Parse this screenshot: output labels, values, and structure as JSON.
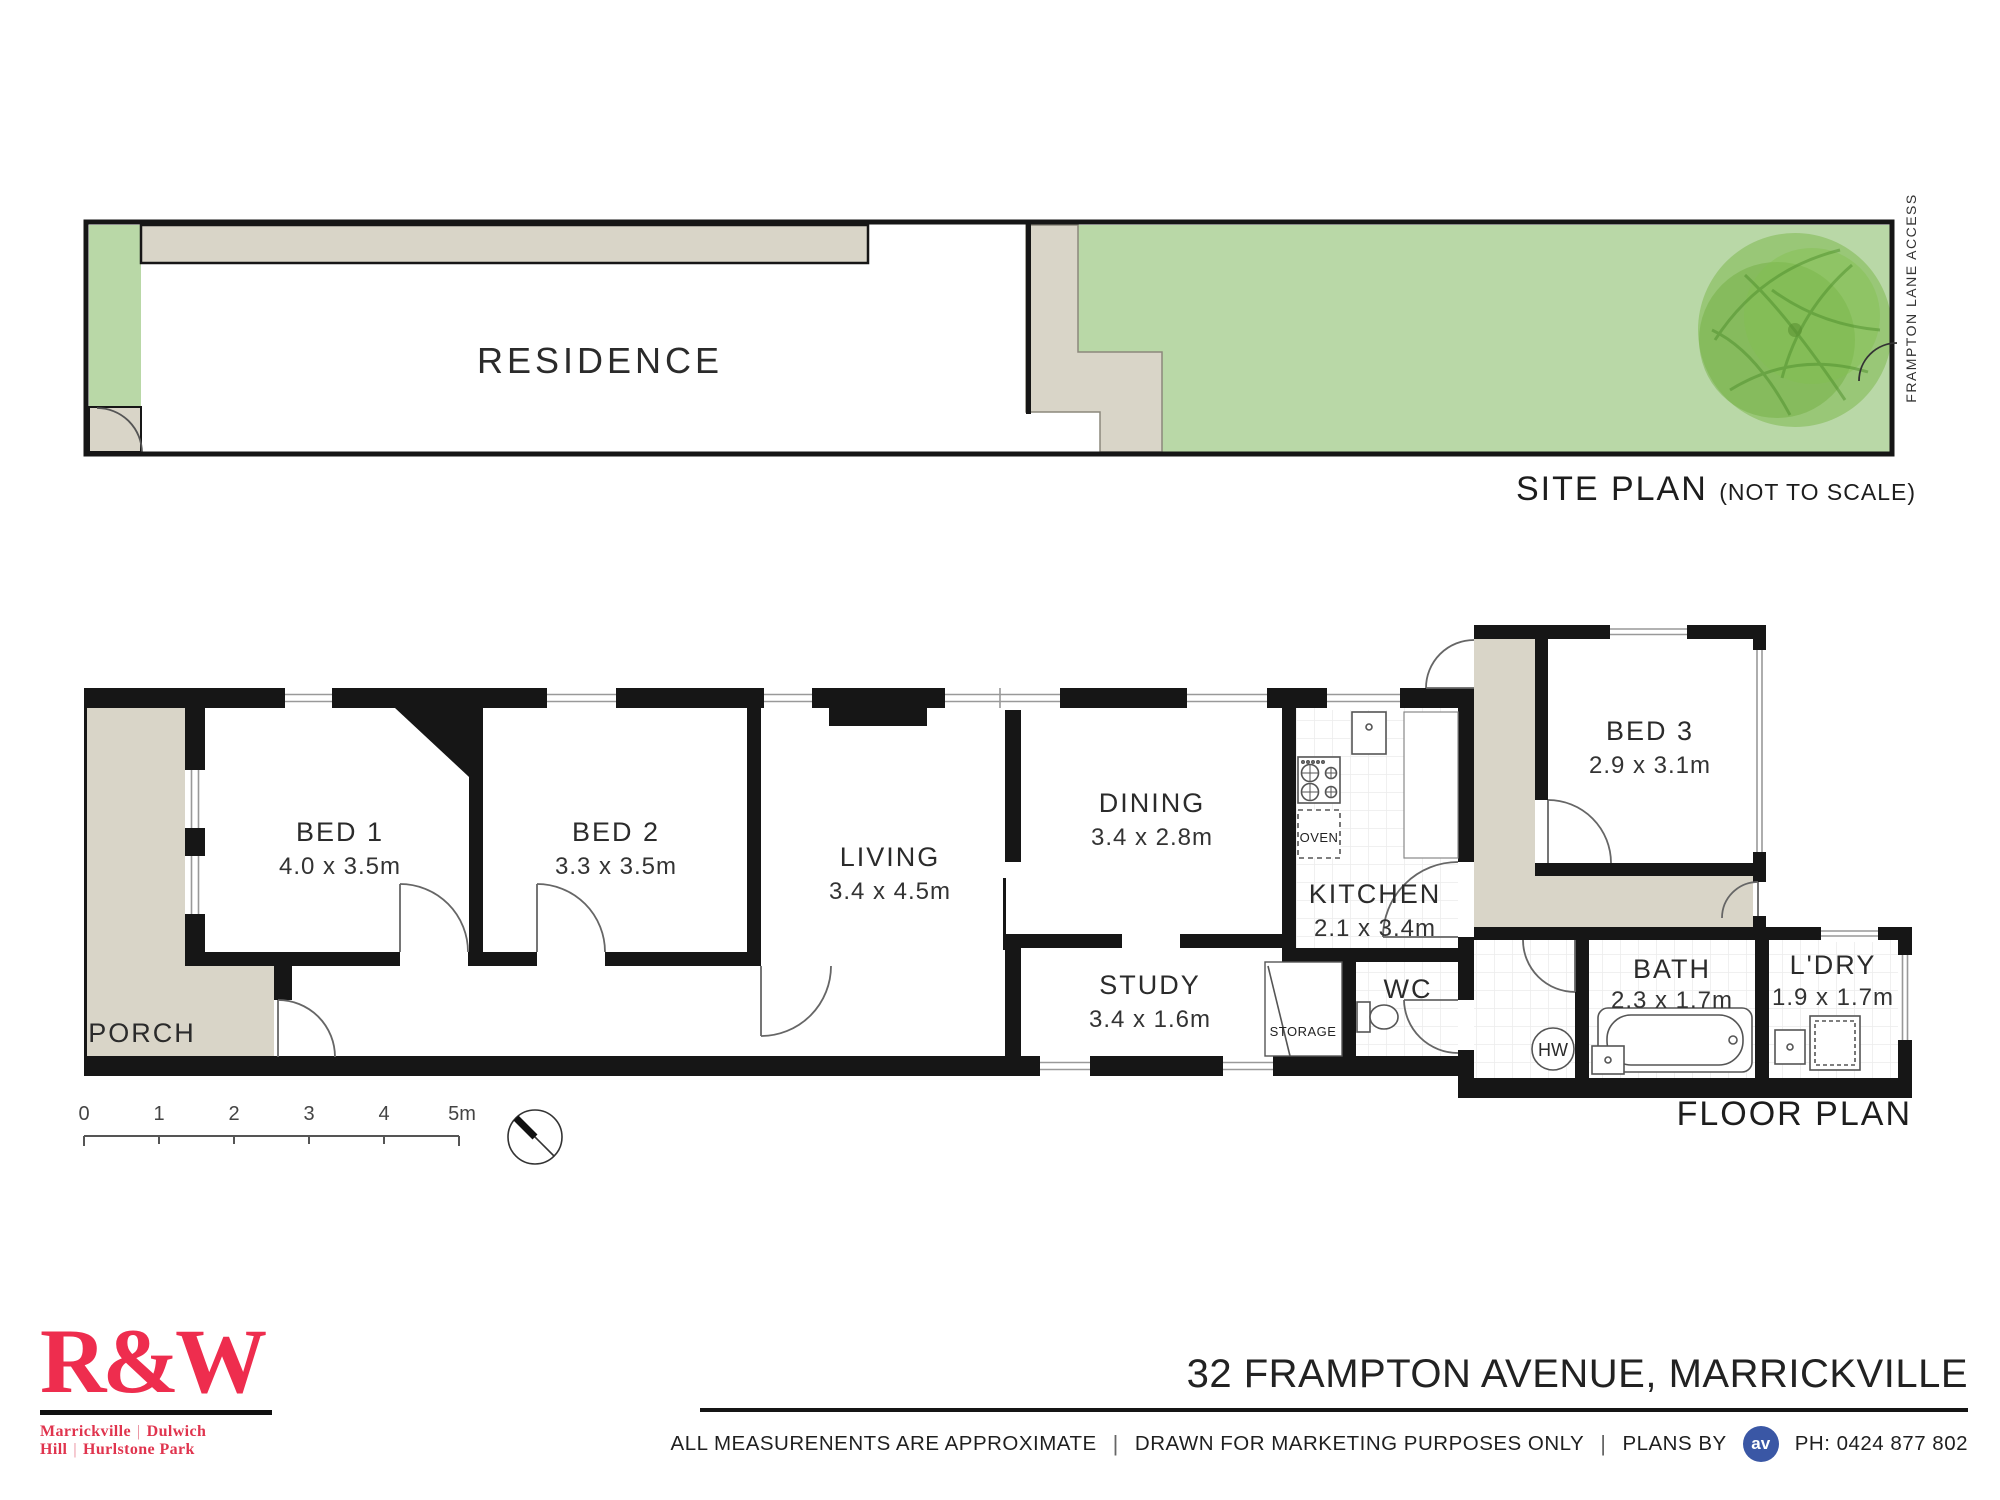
{
  "site_plan": {
    "residence_label": "RESIDENCE",
    "title": "SITE PLAN ",
    "title_suffix": "(NOT TO SCALE)",
    "lane_label": "FRAMPTON  LANE ACCESS"
  },
  "floor_plan": {
    "title": "FLOOR PLAN",
    "rooms": [
      {
        "name": "BED 1",
        "dims": "4.0  x  3.5m"
      },
      {
        "name": "BED 2",
        "dims": "3.3  x  3.5m"
      },
      {
        "name": "LIVING",
        "dims": "3.4  x  4.5m"
      },
      {
        "name": "DINING",
        "dims": "3.4  x  2.8m"
      },
      {
        "name": "KITCHEN",
        "dims": "2.1  x  3.4m"
      },
      {
        "name": "STUDY",
        "dims": "3.4  x  1.6m"
      },
      {
        "name": "BED 3",
        "dims": "2.9  x  3.1m"
      },
      {
        "name": "BATH",
        "dims": "2.3  x  1.7m"
      },
      {
        "name": "L'DRY",
        "dims": "1.9  x  1.7m"
      },
      {
        "name": "WC"
      },
      {
        "name": "PORCH"
      }
    ],
    "fixtures": {
      "oven": "OVEN",
      "storage": "STORAGE",
      "hot_water": "HW"
    },
    "scale_bar": {
      "ticks": [
        "0",
        "1",
        "2",
        "3",
        "4",
        "5m"
      ]
    }
  },
  "footer": {
    "agency": {
      "logo": "R&W",
      "region_1": "Marrickville",
      "region_2": "Dulwich Hill",
      "region_3": "Hurlstone Park",
      "pipe": "|"
    },
    "address": "32 FRAMPTON AVENUE, MARRICKVILLE",
    "disclaimer_1": "ALL MEASURENENTS  ARE APPROXIMATE",
    "pipe": "|",
    "disclaimer_2": "DRAWN FOR MARKETING PURPOSES ONLY",
    "plans_by": "PLANS BY",
    "av_logo": "av",
    "phone": "PH: 0424 877 802"
  },
  "colors": {
    "wall": "#161616",
    "paving": "#d9d5c8",
    "grass": "#b9d8a7",
    "tree": "#76b43e",
    "brand_red": "#ee2d4e",
    "badge_blue": "#3a57a5"
  }
}
